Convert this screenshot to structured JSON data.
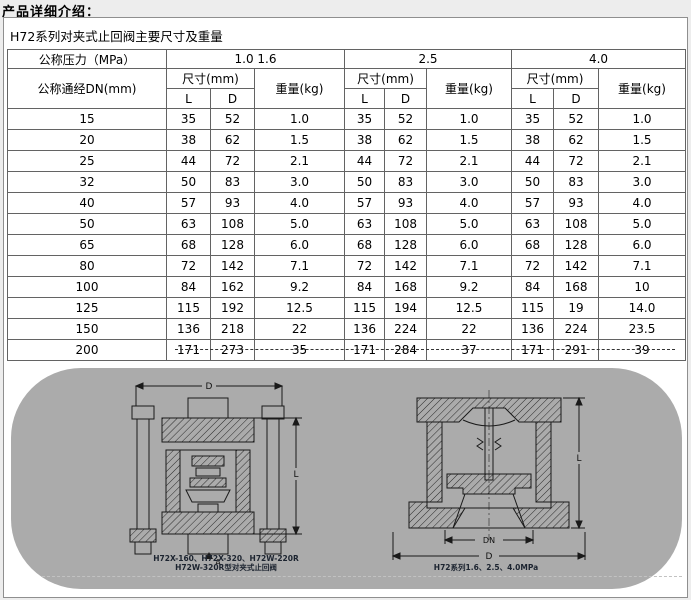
{
  "page": {
    "title": "产品详细介绍："
  },
  "table": {
    "caption": "H72系列对夹式止回阀主要尺寸及重量",
    "pressure_label": "公称压力（MPa）",
    "dn_label": "公称通经DN(mm)",
    "size_label": "尺寸(mm)",
    "weight_label": "重量(kg)",
    "col_l": "L",
    "col_d": "D",
    "pressure_groups": [
      "1.0 1.6",
      "2.5",
      "4.0"
    ],
    "rows": [
      [
        "15",
        "35",
        "52",
        "1.0",
        "35",
        "52",
        "1.0",
        "35",
        "52",
        "1.0"
      ],
      [
        "20",
        "38",
        "62",
        "1.5",
        "38",
        "62",
        "1.5",
        "38",
        "62",
        "1.5"
      ],
      [
        "25",
        "44",
        "72",
        "2.1",
        "44",
        "72",
        "2.1",
        "44",
        "72",
        "2.1"
      ],
      [
        "32",
        "50",
        "83",
        "3.0",
        "50",
        "83",
        "3.0",
        "50",
        "83",
        "3.0"
      ],
      [
        "40",
        "57",
        "93",
        "4.0",
        "57",
        "93",
        "4.0",
        "57",
        "93",
        "4.0"
      ],
      [
        "50",
        "63",
        "108",
        "5.0",
        "63",
        "108",
        "5.0",
        "63",
        "108",
        "5.0"
      ],
      [
        "65",
        "68",
        "128",
        "6.0",
        "68",
        "128",
        "6.0",
        "68",
        "128",
        "6.0"
      ],
      [
        "80",
        "72",
        "142",
        "7.1",
        "72",
        "142",
        "7.1",
        "72",
        "142",
        "7.1"
      ],
      [
        "100",
        "84",
        "162",
        "9.2",
        "84",
        "168",
        "9.2",
        "84",
        "168",
        "10"
      ],
      [
        "125",
        "115",
        "192",
        "12.5",
        "115",
        "194",
        "12.5",
        "115",
        "19",
        "14.0"
      ],
      [
        "150",
        "136",
        "218",
        "22",
        "136",
        "224",
        "22",
        "136",
        "224",
        "23.5"
      ],
      [
        "200",
        "171",
        "273",
        "35",
        "171",
        "284",
        "37",
        "171",
        "291",
        "39"
      ]
    ]
  },
  "drawings": {
    "left_caption_line1": "H72X-160、H72X-320、H72W-220R",
    "left_caption_line2": "H72W-320R型对夹式止回阀",
    "right_caption": "H72系列1.6、2.5、4.0MPa",
    "dims": {
      "d": "D",
      "l": "L",
      "dn": "DN",
      "a": "A"
    }
  }
}
